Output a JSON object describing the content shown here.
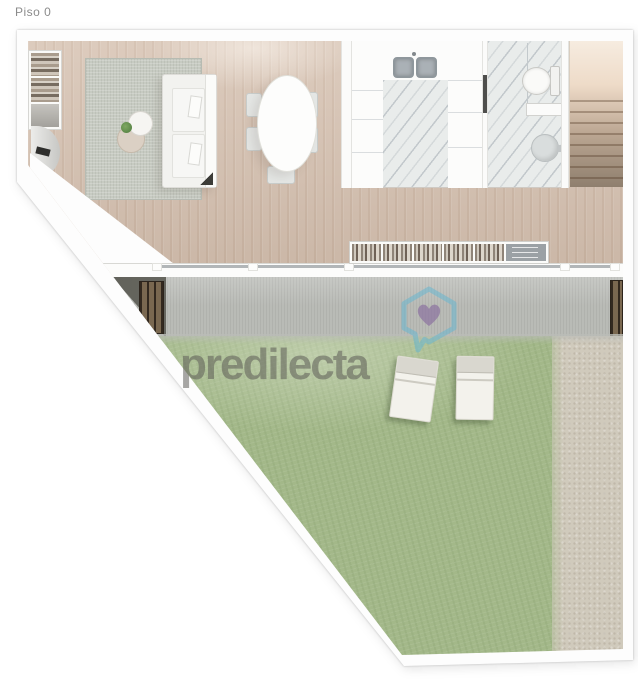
{
  "page": {
    "floor_label": "Piso 0",
    "background_color": "#ffffff"
  },
  "watermark": {
    "text": "predilecta",
    "logo_icon": "house-heart-chat-bubble-icon",
    "logo_outline_color": "#67b7cf",
    "heart_color": "#8b72a0",
    "text_color": "#585653"
  },
  "floor_plan": {
    "type": "residential-floor-plan-top-view",
    "floor_shown": "ground-floor",
    "rooms": [
      {
        "name": "living-dining-room",
        "floor": "wood",
        "floor_color": "#d5c0af"
      },
      {
        "name": "kitchen",
        "floor": "marble",
        "floor_color": "#e9eceb"
      },
      {
        "name": "bathroom",
        "floor": "marble",
        "floor_color": "#e9eceb"
      },
      {
        "name": "staircase",
        "steps_visible": 9,
        "color": "#bda894"
      },
      {
        "name": "patio-terrace",
        "floor": "concrete",
        "floor_color": "#b9bbb6"
      },
      {
        "name": "garden",
        "floor": "grass",
        "floor_color": "#a3b889"
      },
      {
        "name": "gravel-strip",
        "floor": "gravel",
        "floor_color": "#d0cabc"
      }
    ],
    "furniture": [
      "bookshelf",
      "entry-door-swing",
      "area-rug",
      "two-seat-sofa",
      "coffee-table-pair",
      "potted-plant",
      "oval-dining-table",
      "dining-chairs-x5",
      "double-kitchen-sink",
      "kitchen-cabinets",
      "toilet",
      "washbasin",
      "sideboard-shelf",
      "wood-slat-bench-left",
      "wood-slat-bench-right",
      "sun-lounger-x2"
    ],
    "wall_color": "#fdfdfd",
    "outline_color": "#b8b8b8"
  }
}
